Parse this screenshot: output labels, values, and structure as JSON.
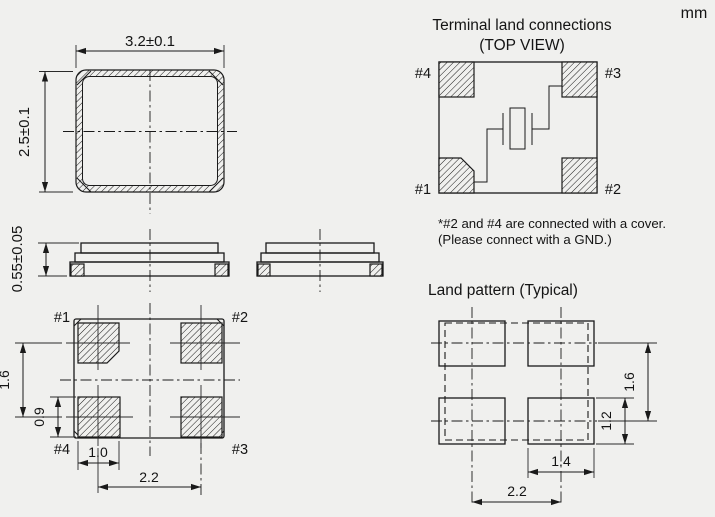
{
  "unit_label": "mm",
  "colors": {
    "background": "#f0f0ee",
    "line": "#1a1a1a"
  },
  "top_view": {
    "width_dim": "3.2±0.1",
    "height_dim": "2.5±0.1"
  },
  "side_view": {
    "height_dim": "0.55±0.05"
  },
  "bottom_view": {
    "pad_labels": {
      "top_left": "#1",
      "top_right": "#2",
      "bottom_right": "#3",
      "bottom_left": "#4"
    },
    "dim_pad_pitch_vertical": "1.6",
    "dim_pad_height": "0.9",
    "dim_pad_width": "1.0",
    "dim_pad_pitch_horizontal": "2.2"
  },
  "terminal_land_connections": {
    "title": "Terminal land connections",
    "subtitle": "(TOP VIEW)",
    "pad_labels": {
      "top_left": "#4",
      "top_right": "#3",
      "bottom_left": "#1",
      "bottom_right": "#2"
    },
    "note_line1": "*#2 and #4 are connected with a cover.",
    "note_line2": "(Please connect with a GND.)"
  },
  "land_pattern": {
    "title": "Land pattern (Typical)",
    "dim_row_pitch": "1.6",
    "dim_pad_height": "1.2",
    "dim_pad_width": "1.4",
    "dim_column_pitch": "2.2"
  }
}
